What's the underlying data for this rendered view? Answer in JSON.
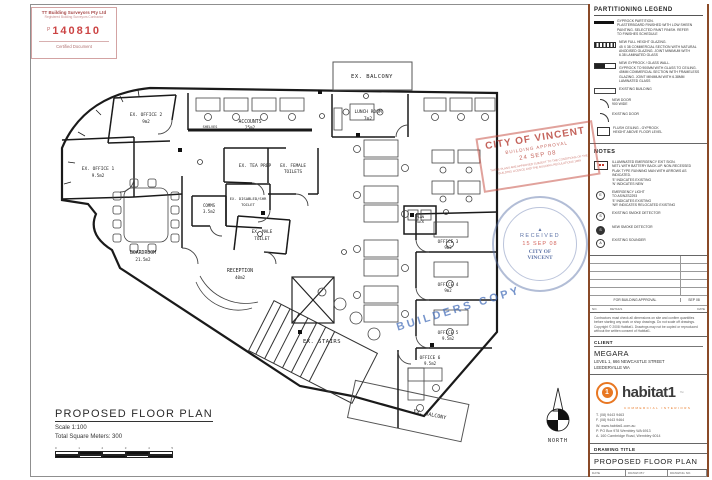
{
  "cert_stamp": {
    "company": "TT Building Surveyors Pty Ltd",
    "subtitle": "Registered Building Surveyors Contractor",
    "prefix": "P",
    "number": "140810",
    "footer": "Certified Document"
  },
  "legend": {
    "title": "PARTITIONING LEGEND",
    "items": [
      {
        "text": "GYPROCK PARTITION.\nPLASTERBOARD FINISHED WITH LOW SHEEN\nPAINTING. SELECTED PAINT FINISH. REFER\nTO FINISHES SCHEDULE"
      },
      {
        "text": "NEW FULL HEIGHT GLAZING.\n45 X 38 COMMERCIAL SECTION WITH NATURAL\nANODISED GLAZING. JOINT MINIMUM WITH\n6.38 LAMINATED GLASS"
      },
      {
        "text": "NEW GYPROCK / GLASS WALL.\nGYPROCK TO 900MM WITH GLASS TO CEILING.\n45MM COMMERCIAL SECTION WITH FRAMELESS\nGLAZING. JOINT MINIMUM WITH 6.38MM\nLAMINATED GLASS"
      },
      {
        "text": "EXISTING BUILDING"
      },
      {
        "text": "NEW DOOR\n900 WIDE"
      },
      {
        "text": "EXISTING DOOR"
      },
      {
        "text": "FLUSH CEILING - GYPROCK\nHEIGHT ABOVE FLOOR LEVEL"
      }
    ]
  },
  "notes": {
    "title": "NOTES",
    "items": [
      {
        "text": "ILLUMINATED EMERGENCY EXIT SIGN.\nNETL WITH BATTERY BACK-UP. NON-RECESSED\nPLAK TYPE RUNNING MAN WITH ARROWS AS\nINDICATED.\n'E' INDICATES EXISTING\n'N' INDICATES NEW"
      },
      {
        "text": "EMERGENCY LIGHT\nTO AS/NZS2293\n'E' INDICATES EXISTING\n'NR' INDICATES RELOCATED EXISTING"
      },
      {
        "text": "EXISTING SMOKE DETECTOR"
      },
      {
        "text": "NEW SMOKE DETECTOR"
      },
      {
        "text": "EXISTING SOUNDER"
      }
    ]
  },
  "revision_table": {
    "issue": {
      "details": "FOR BUILDING APPROVAL",
      "date": "SEP 08"
    },
    "foot": {
      "no": "NO.",
      "details": "DETAILS",
      "date": "DATE"
    }
  },
  "disclaimer": "Contractors must check all dimensions on site and confirm quantities before starting any work or shop drawings. Do not scale off drawings. Copyright © 2008 Habitat1. Drawings may not be copied or reproduced without the written consent of Habitat1.",
  "client_block": {
    "label": "CLIENT",
    "name": "MEGARA",
    "address1": "LEVEL 1, 666 NEWCASTLE STREET",
    "address2": "LEEDERVILLE WA"
  },
  "logo": {
    "mark": "1",
    "brand": "habitat1",
    "tm": "™",
    "tagline": "COMMERCIAL INTERIORS",
    "contacts": [
      "T. (08) 9443 9463",
      "F. (08) 9443 9464",
      "W. www.habitat1.com.au",
      "P. PO Box 978 Wembley WA 6913",
      "A. 160 Cambridge Road, Wembley 6014"
    ]
  },
  "title_block": {
    "drawing_title_label": "DRAWING TITLE",
    "drawing_title": "PROPOSED FLOOR PLAN",
    "date_label": "DATE",
    "date": "JUL 08",
    "drawn_by_label": "DRAWN BY",
    "drawn_by": "WH",
    "drawing_no_label": "DRAWING NO.",
    "drawing_no": "00",
    "scale_label": "SCALE",
    "scale": "1:100@A1",
    "revision_label": "REVISION",
    "revision": "-"
  },
  "footer": {
    "title": "PROPOSED FLOOR PLAN",
    "scale": "Scale 1:100",
    "total": "Total Square Meters: 300",
    "ticks": [
      "0",
      "1",
      "2",
      "3",
      "4",
      "5"
    ]
  },
  "stamps": {
    "approval": {
      "line1": "CITY OF VINCENT",
      "line2": "BUILDING APPROVAL",
      "date": "24 SEP 08",
      "conditions": "THESE PLANS ARE APPROVED SUBJECT TO THE CONDITIONS OF THE BUILDING LICENCE AND THE BUILDING REGULATIONS 1989"
    },
    "received": {
      "mark": "▲",
      "top": "RECEIVED",
      "date": "15 SEP 08",
      "org1": "CITY OF",
      "org2": "VINCENT"
    },
    "builders_copy": "BUILDERS COPY"
  },
  "north": {
    "label": "NORTH"
  },
  "plan": {
    "colors": {
      "wall": "#1a1a1a",
      "furniture": "#444",
      "stamp_red": "#c0392b",
      "stamp_blue": "#4a70ba",
      "accent": "#e87722"
    },
    "rooms": {
      "balcony_top": {
        "name": "EX. BALCONY"
      },
      "lunch": {
        "name": "LUNCH ROOM",
        "area": "7m2"
      },
      "accounts": {
        "name": "ACCOUNTS",
        "area": "25m2"
      },
      "shelves": {
        "name": "SHELVES"
      },
      "office2": {
        "name": "EX. OFFICE 2",
        "area": "9m2"
      },
      "office1": {
        "name": "EX. OFFICE 1",
        "area": "9.5m2"
      },
      "teaprep": {
        "name": "EX. TEA PREP"
      },
      "femalet": {
        "name": "EX. FEMALE",
        "name2": "TOILETS"
      },
      "disabled": {
        "name": "EX. DISABLED/SHR",
        "name2": "TOILET"
      },
      "malet": {
        "name": "EX. MALE",
        "name2": "TOILET"
      },
      "boardroom": {
        "name": "BOARDROOM",
        "area": "21.5m2"
      },
      "comms": {
        "name": "COMMS",
        "area": "3.5m2"
      },
      "reception": {
        "name": "RECEPTION",
        "area": "40m2"
      },
      "stairs": {
        "name": "EX. STAIRS"
      },
      "planrack": {
        "name": "PLAN",
        "name2": "RACK"
      },
      "office3": {
        "name": "OFFICE 3",
        "area": "9m2"
      },
      "office4": {
        "name": "OFFICE 4",
        "area": "9m2"
      },
      "office5": {
        "name": "OFFICE 5",
        "area": "9.5m2"
      },
      "office6": {
        "name": "OFFICE 6",
        "area": "9.5m2"
      },
      "balcony_bottom": {
        "name": "EX. BALCONY"
      }
    }
  }
}
